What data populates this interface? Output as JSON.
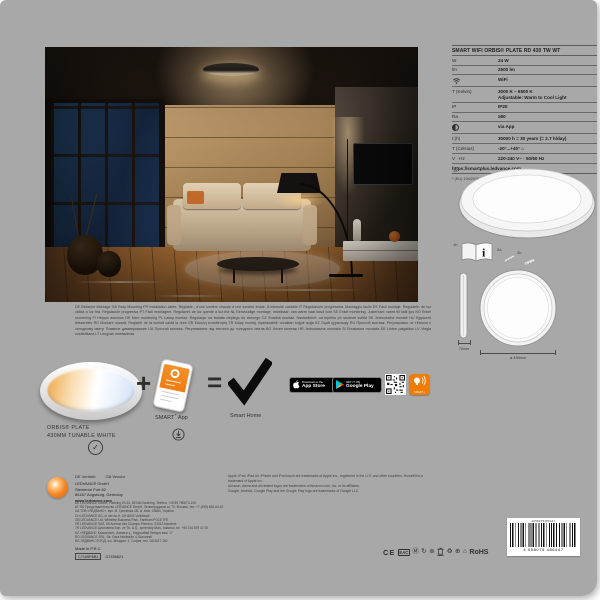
{
  "spec_table": {
    "title": "SMART WIFI ORBIS® PLATE RD 430 TW WT",
    "rows": [
      {
        "label": "W",
        "value": "24 W"
      },
      {
        "label": "lm",
        "value": "2500 lm"
      },
      {
        "label": "",
        "value": "WiFi"
      },
      {
        "label": "T (Kelvin)",
        "value": "3000 K – 6500 K",
        "value2": "Adjustable: Warm to Cool Light"
      },
      {
        "label": "IP",
        "value": "IP20"
      },
      {
        "label": "Ra",
        "value": "≥80"
      },
      {
        "label": "",
        "value": "via App"
      },
      {
        "label": "t (h)",
        "value": "30000 h = 30 years (= 2.7 h/day)"
      },
      {
        "label": "T (Celsius)",
        "value": "-20°...+40°"
      },
      {
        "label": "V · Hz",
        "value": "220-240 V~ · 50/60 Hz"
      }
    ],
    "url": "https://smartplus.ledvance.com",
    "footnote": "* (EU) 194/2019"
  },
  "drawings": {
    "label_1a": "1a",
    "label_1b": "1b",
    "label_2a": "2a",
    "label_2b": "2b",
    "book_info": "i",
    "dim_height": "70mm",
    "dim_diameter": "ø 430mm"
  },
  "legal": {
    "paragraph": "DE Einfache Montage GB Easy Mounting FR Installation aisée. Réglable : d'une lumière chaude à une lumière froide. À intensité variable IT Regolazione progressiva. Montaggio facile ES Fácil montaje. Regulable: de luz cálida a luz fría. Regulación progresiva PT Fácil montagem. Regulável: de luz quente a luz fria NL Eenvoudige montage. Instelbaar: van warm naar koud licht SE Enkel montering. Justerbart: varmt till kallt ljus NO Enkel montering FI Helppo asennus DK Nem montering PL Łatwy montaż. Regulacja: od światła ciepłego do zimnego CZ Snadná montáž. Nastavitelné: od teplého po studené světlo SK Jednoduchá montáž HU Egyszerű felszerelés RO Montare ușoară. Reglabil: de la lumină caldă la rece GR Εύκολη τοποθέτηση TR Kolay montaj. Ayarlanabilir: sıcaktan soğuk ışığa KZ Оңай құрастыру RU Простой монтаж. Регулировка: от тёплого к холодному свету. Плавное диммирование UA Простий монтаж. Регулювання: від теплого до холодного світла BG Лесен монтаж HR Jednostavna montaža SI Enostavna montaža EE Lihtne paigaldus LV Viegla uzstādīšana LT Lengvas montavimas"
  },
  "product_row": {
    "plus": "+",
    "equals": "=",
    "product_name_line1": "ORBIS® PLATE",
    "product_name_line2": "430MM TUNABLE WHITE",
    "check": "✓",
    "app_brand": "SMART",
    "app_sup": "+",
    "app_word": " App",
    "smart_home": "Smart Home",
    "appstore_top": "Download on the",
    "appstore_bottom": "App Store",
    "googleplay_top": "GET IT ON",
    "googleplay_bottom": "Google Play",
    "wifi_badge_label": "SMART+"
  },
  "vendor": {
    "heading_de": "DE Vertrieb",
    "heading_gb": "GB Vendor",
    "company": "LEDVANCE GmbH",
    "street": "Steinerne Furt 62",
    "city": "86167 Augsburg, Germany",
    "website": "www.ledvance.com",
    "addresses": "DE LEDVANCE GmbH, Parkring 29-33, 85748 Garching, Telefon: +49 89 780673-100\nAT RU Представительство LEDVANCE GmbH, Ленинградское ш. 72, Москва, тел. +7 (495) 662-64-62\nUA ТОВ «ЛЕДВАНС», вул. М. Грінченка 4В, м. Київ, 03680, Україна\nCH LEDVANCE AG, In der Au 6, CH-8604 Volketswil\nGB LEDVANCE Ltd, Whiteley Business Park, Fareham PO15 7FE\nFR LEDVANCE SAS, 55 Avenue des Champs Pierreux, 92012 Nanterre\nTR LEDVANCE Aydınlatma San. ve Tic. A.Ş., İçerenköy Mah., İstanbul, tel. +90 216 579 47 00\nKZ «ЛЕДВАНС Казахстан», Алматы қ., Наурызбай батыра көш. 17\nRO LEDVANCE SRL, Str. Gara Herăstrău 4, București\nBG ЛЕДВАНС ЕООД, ж.к. Младост 4, София, тел. 02/4917 160",
    "made_in": "Made in P.R.C.",
    "code_boxed": "C7106P6B1",
    "code_plain": "G7456621"
  },
  "trademarks": {
    "paragraph": "Apple, iPad, iPad Air, iPhone and iPod touch are trademarks of Apple Inc., registered in the U.S. and other countries. HomeKit is a trademark of Apple Inc.\nAmazon, Alexa and all related logos are trademarks of Amazon.com, Inc. or its affiliates.\nGoogle, Android, Google Play and the Google Play logo are trademarks of Google LLC."
  },
  "certifications": {
    "ce": "CE",
    "eac": "EAC",
    "m_circle": "Ⓜ",
    "recycle_arrow": "↻",
    "star": "⊛",
    "recycle": "♻",
    "plus_circle": "⊕",
    "house": "⌂",
    "rohs": "RoHS"
  },
  "barcode": {
    "top_number": "4058075486447",
    "number": "4 058075 486447"
  },
  "colors": {
    "brand_orange": "#f07d00",
    "sheet_gray": "#a8a8a8"
  }
}
